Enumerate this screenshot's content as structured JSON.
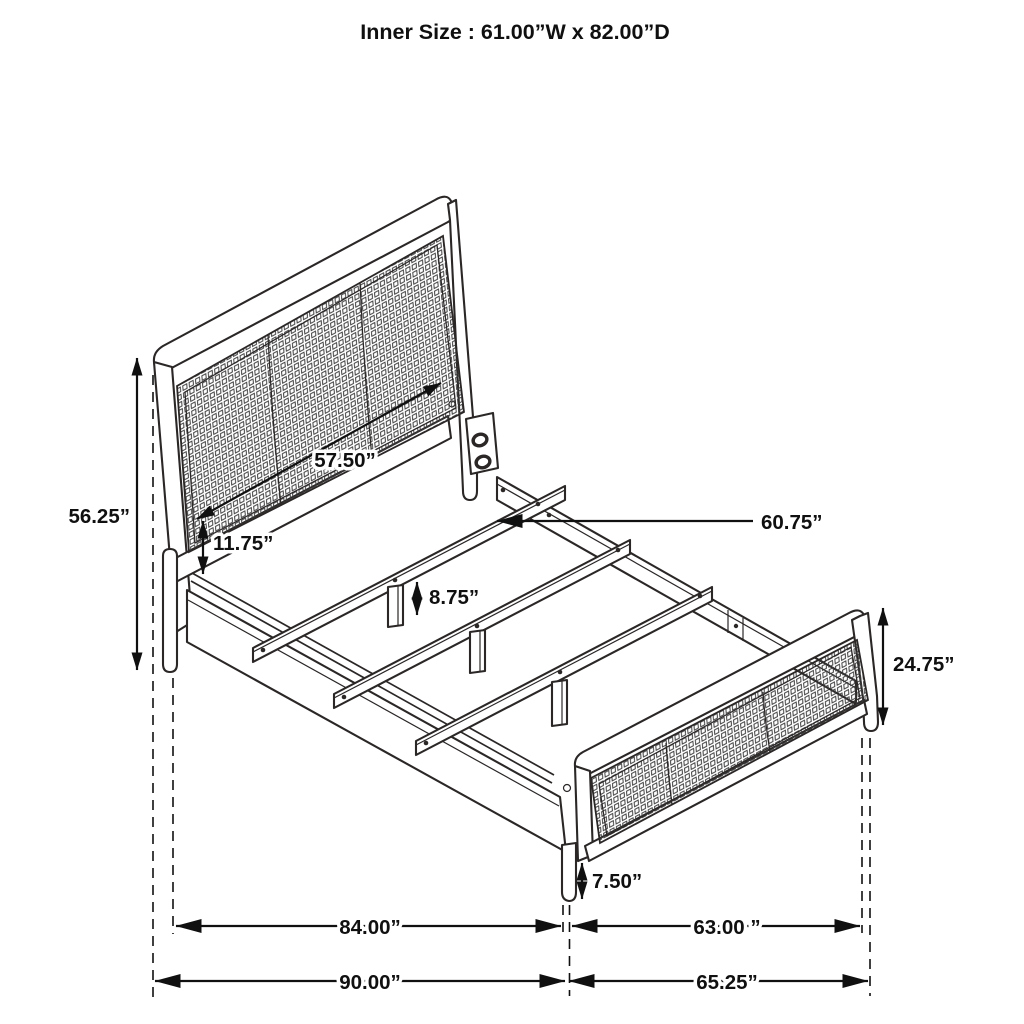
{
  "title": "Inner Size : 61.00”W x 82.00”D",
  "labels": {
    "headboard_height": "56.25”",
    "headboard_panel_width": "57.50”",
    "panel_to_rail_gap": "11.75”",
    "center_support_leg_height": "8.75”",
    "slat_length": "60.75”",
    "footboard_height": "24.75”",
    "footboard_leg_height": "7.50”",
    "side_rail_span": "84.00”",
    "footboard_span": "63.00 ”",
    "overall_length": "90.00”",
    "footboard_overall_span": "65.25”"
  },
  "colors": {
    "line": "#2b2727",
    "dimension": "#101010",
    "mesh_line": "#3b3b3b",
    "background": "#ffffff",
    "text": "#101010"
  }
}
